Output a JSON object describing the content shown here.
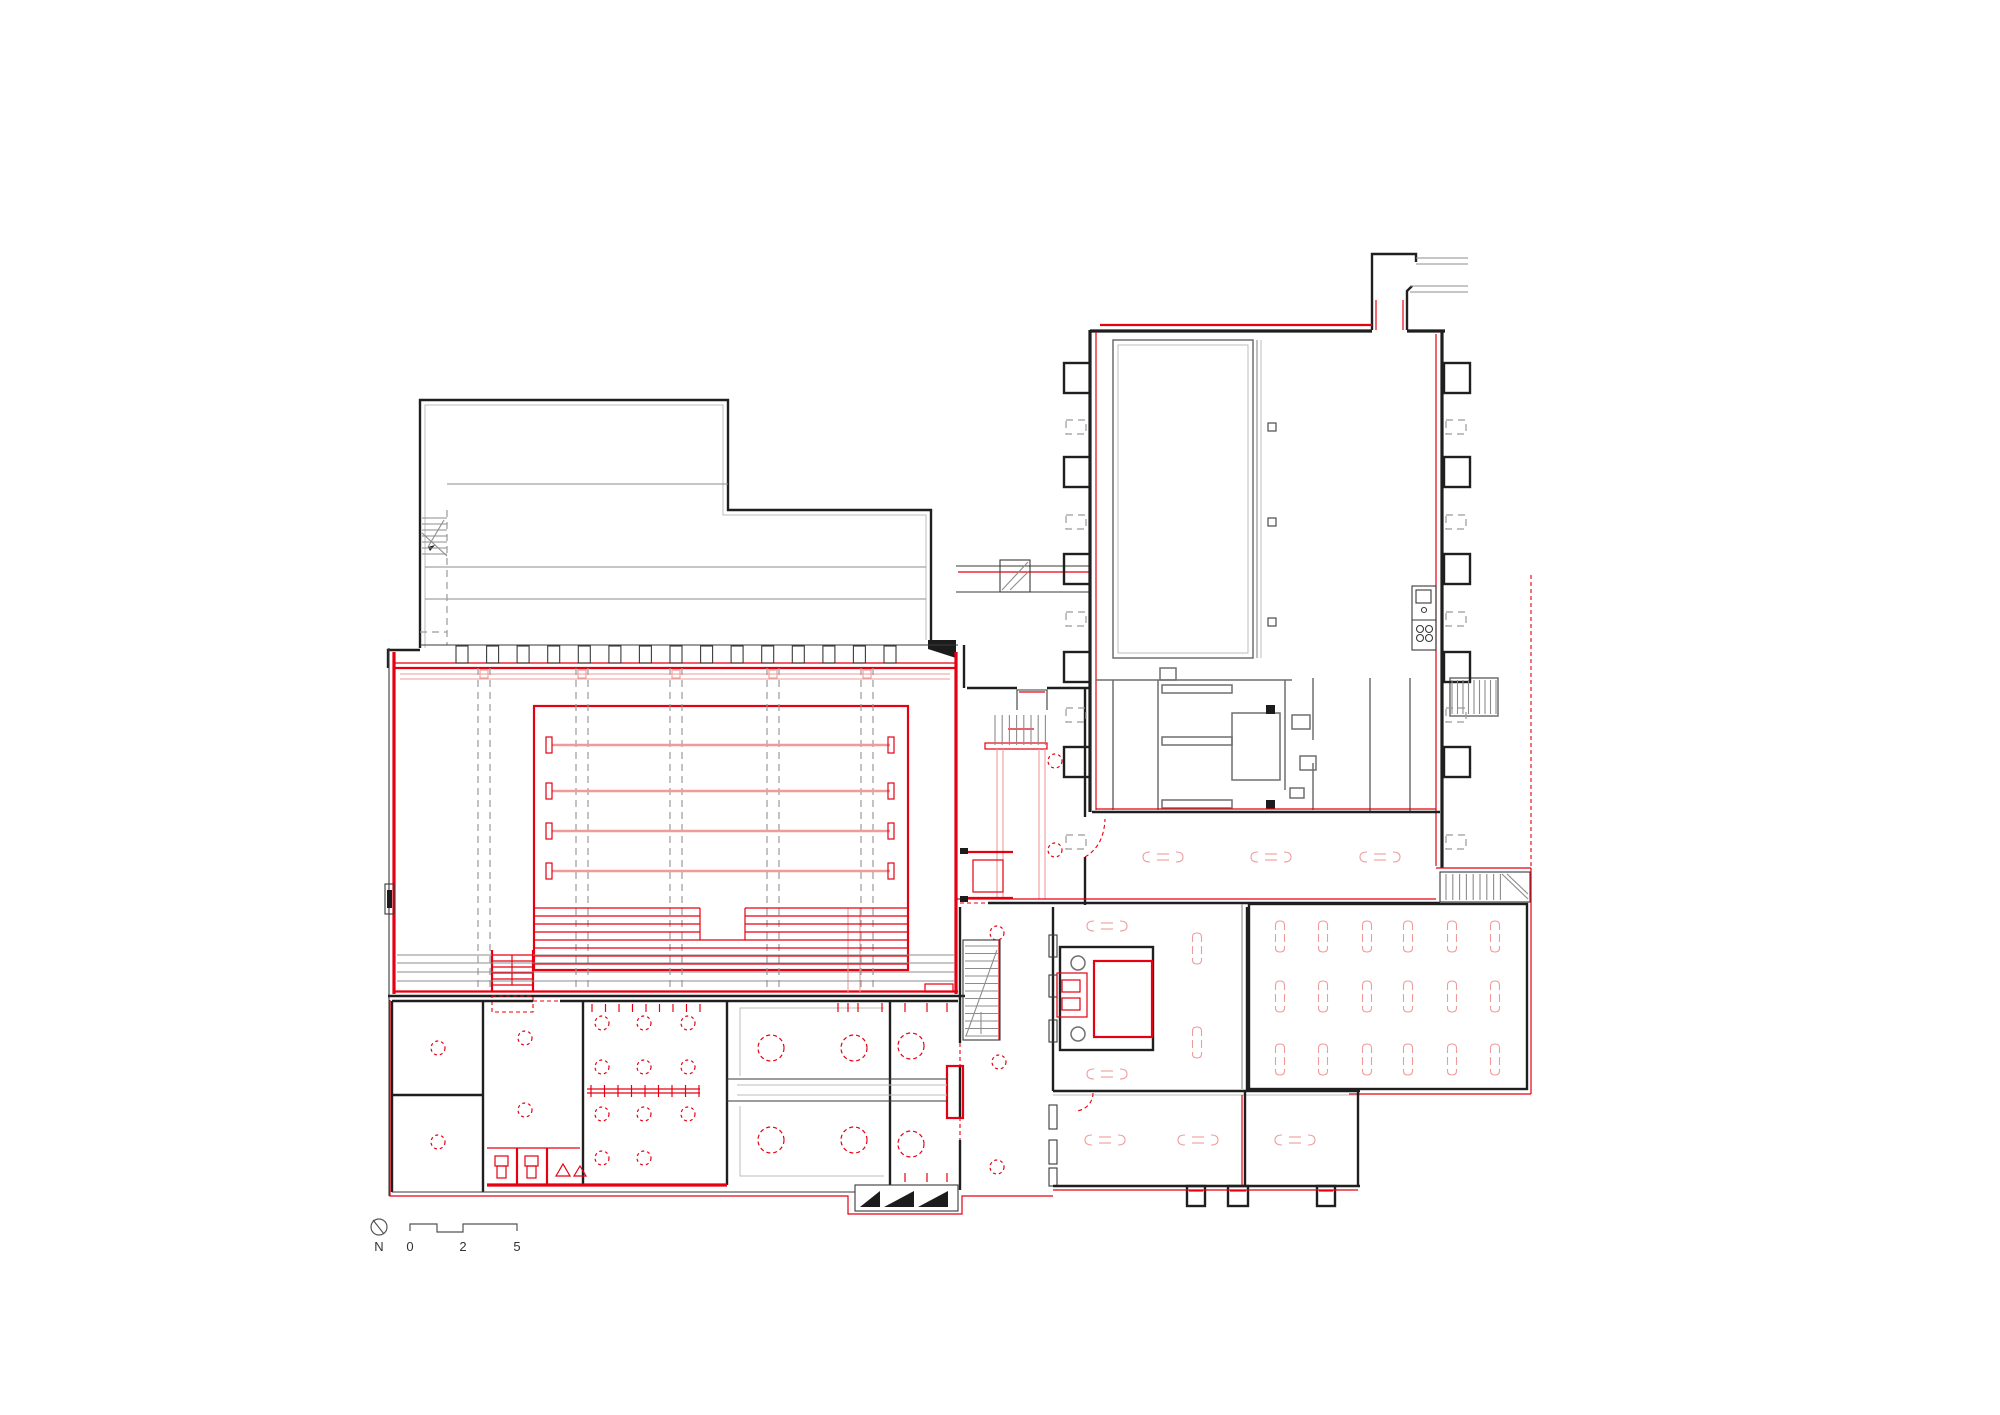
{
  "document": {
    "type": "architectural floor plan"
  },
  "colors": {
    "wall_black": "#1f1f1f",
    "line_gray": "#8c8c8c",
    "light_gray": "#bdbdbd",
    "red": "#e60012",
    "light_red": "#f09a9a",
    "background": "#ffffff"
  },
  "scale_bar": {
    "north_label": "N",
    "labels": [
      "0",
      "2",
      "5"
    ]
  },
  "plan": {
    "hall_grid_x": [
      478,
      490,
      576,
      588,
      670,
      682,
      767,
      779,
      861,
      873
    ],
    "lane_y": [
      745,
      791,
      831,
      871
    ],
    "step_y": [
      908,
      916,
      924,
      932,
      940,
      948,
      956,
      964
    ],
    "walkway_y": [
      955,
      963,
      972,
      981
    ],
    "column_x": [
      462,
      492.6,
      523.1,
      553.7,
      584.3,
      614.9,
      645.4,
      676,
      706.6,
      737.1,
      767.7,
      798.3,
      828.9,
      859.4,
      890
    ],
    "balcony_sq_x": [
      484,
      582,
      676,
      773,
      867
    ],
    "buttress_solid_y": [
      363,
      457,
      554,
      652,
      747
    ],
    "buttress_dash_y": [
      420,
      515,
      612,
      708,
      835
    ],
    "col_squares": [
      [
        1268,
        423
      ],
      [
        1268,
        518
      ],
      [
        1268,
        618
      ]
    ],
    "bench_h": [
      [
        1163,
        857
      ],
      [
        1271,
        857
      ],
      [
        1380,
        857
      ],
      [
        1105,
        1140
      ],
      [
        1198,
        1140
      ],
      [
        1295,
        1140
      ],
      [
        1107,
        926
      ],
      [
        1107,
        1074
      ]
    ],
    "bench_v_cols": [
      1280,
      1323,
      1367,
      1408,
      1452,
      1495
    ],
    "bench_v_rows": [
      936,
      996,
      1059
    ],
    "bench_v_extra": [
      [
        1197,
        948
      ],
      [
        1197,
        1042
      ]
    ],
    "circ_small": [
      [
        438,
        1048
      ],
      [
        438,
        1142
      ],
      [
        525,
        1038
      ],
      [
        525,
        1110
      ],
      [
        602,
        1023
      ],
      [
        644,
        1023
      ],
      [
        688,
        1023
      ],
      [
        602,
        1067
      ],
      [
        644,
        1067
      ],
      [
        688,
        1067
      ],
      [
        602,
        1114
      ],
      [
        644,
        1114
      ],
      [
        688,
        1114
      ],
      [
        602,
        1158
      ],
      [
        644,
        1158
      ],
      [
        997,
        933
      ],
      [
        999,
        1062
      ],
      [
        997,
        1167
      ],
      [
        1055,
        761
      ],
      [
        1055,
        850
      ]
    ],
    "circ_big": [
      [
        771,
        1048
      ],
      [
        854,
        1048
      ],
      [
        771,
        1140
      ],
      [
        854,
        1140
      ],
      [
        911,
        1046
      ],
      [
        911,
        1144
      ]
    ],
    "hooks": [
      [
        905,
        1003
      ],
      [
        927,
        1003
      ],
      [
        947,
        1003
      ],
      [
        905,
        1173
      ],
      [
        927,
        1173
      ],
      [
        947,
        1173
      ],
      [
        838,
        1003
      ],
      [
        848,
        1003
      ],
      [
        858,
        1003
      ],
      [
        882,
        1003
      ]
    ],
    "tick_bench": {
      "x1": 591,
      "x2": 699,
      "y": 1091,
      "step": 13.5
    },
    "hook_row": {
      "x1": 592,
      "x2": 700,
      "y": 1004,
      "step": 13.5
    },
    "treads": [
      {
        "o": "h",
        "x1": 422,
        "x2": 447,
        "y1": 518,
        "y2": 556,
        "step": 6,
        "c": "g"
      },
      {
        "o": "h",
        "x1": 492,
        "x2": 533,
        "y1": 955,
        "y2": 987,
        "step": 6,
        "c": "r1"
      },
      {
        "o": "v",
        "x1": 995,
        "x2": 1046,
        "y1": 715,
        "y2": 745,
        "step": 7.2,
        "c": "g"
      },
      {
        "o": "h",
        "x1": 965,
        "x2": 998,
        "y1": 946,
        "y2": 1036,
        "step": 7.5,
        "c": "g"
      },
      {
        "o": "v",
        "x1": 1446,
        "x2": 1502,
        "y1": 874,
        "y2": 900,
        "step": 6.8,
        "c": "g"
      },
      {
        "o": "v",
        "x1": 1452,
        "x2": 1497,
        "y1": 680,
        "y2": 714,
        "step": 5.5,
        "c": "g"
      }
    ]
  }
}
